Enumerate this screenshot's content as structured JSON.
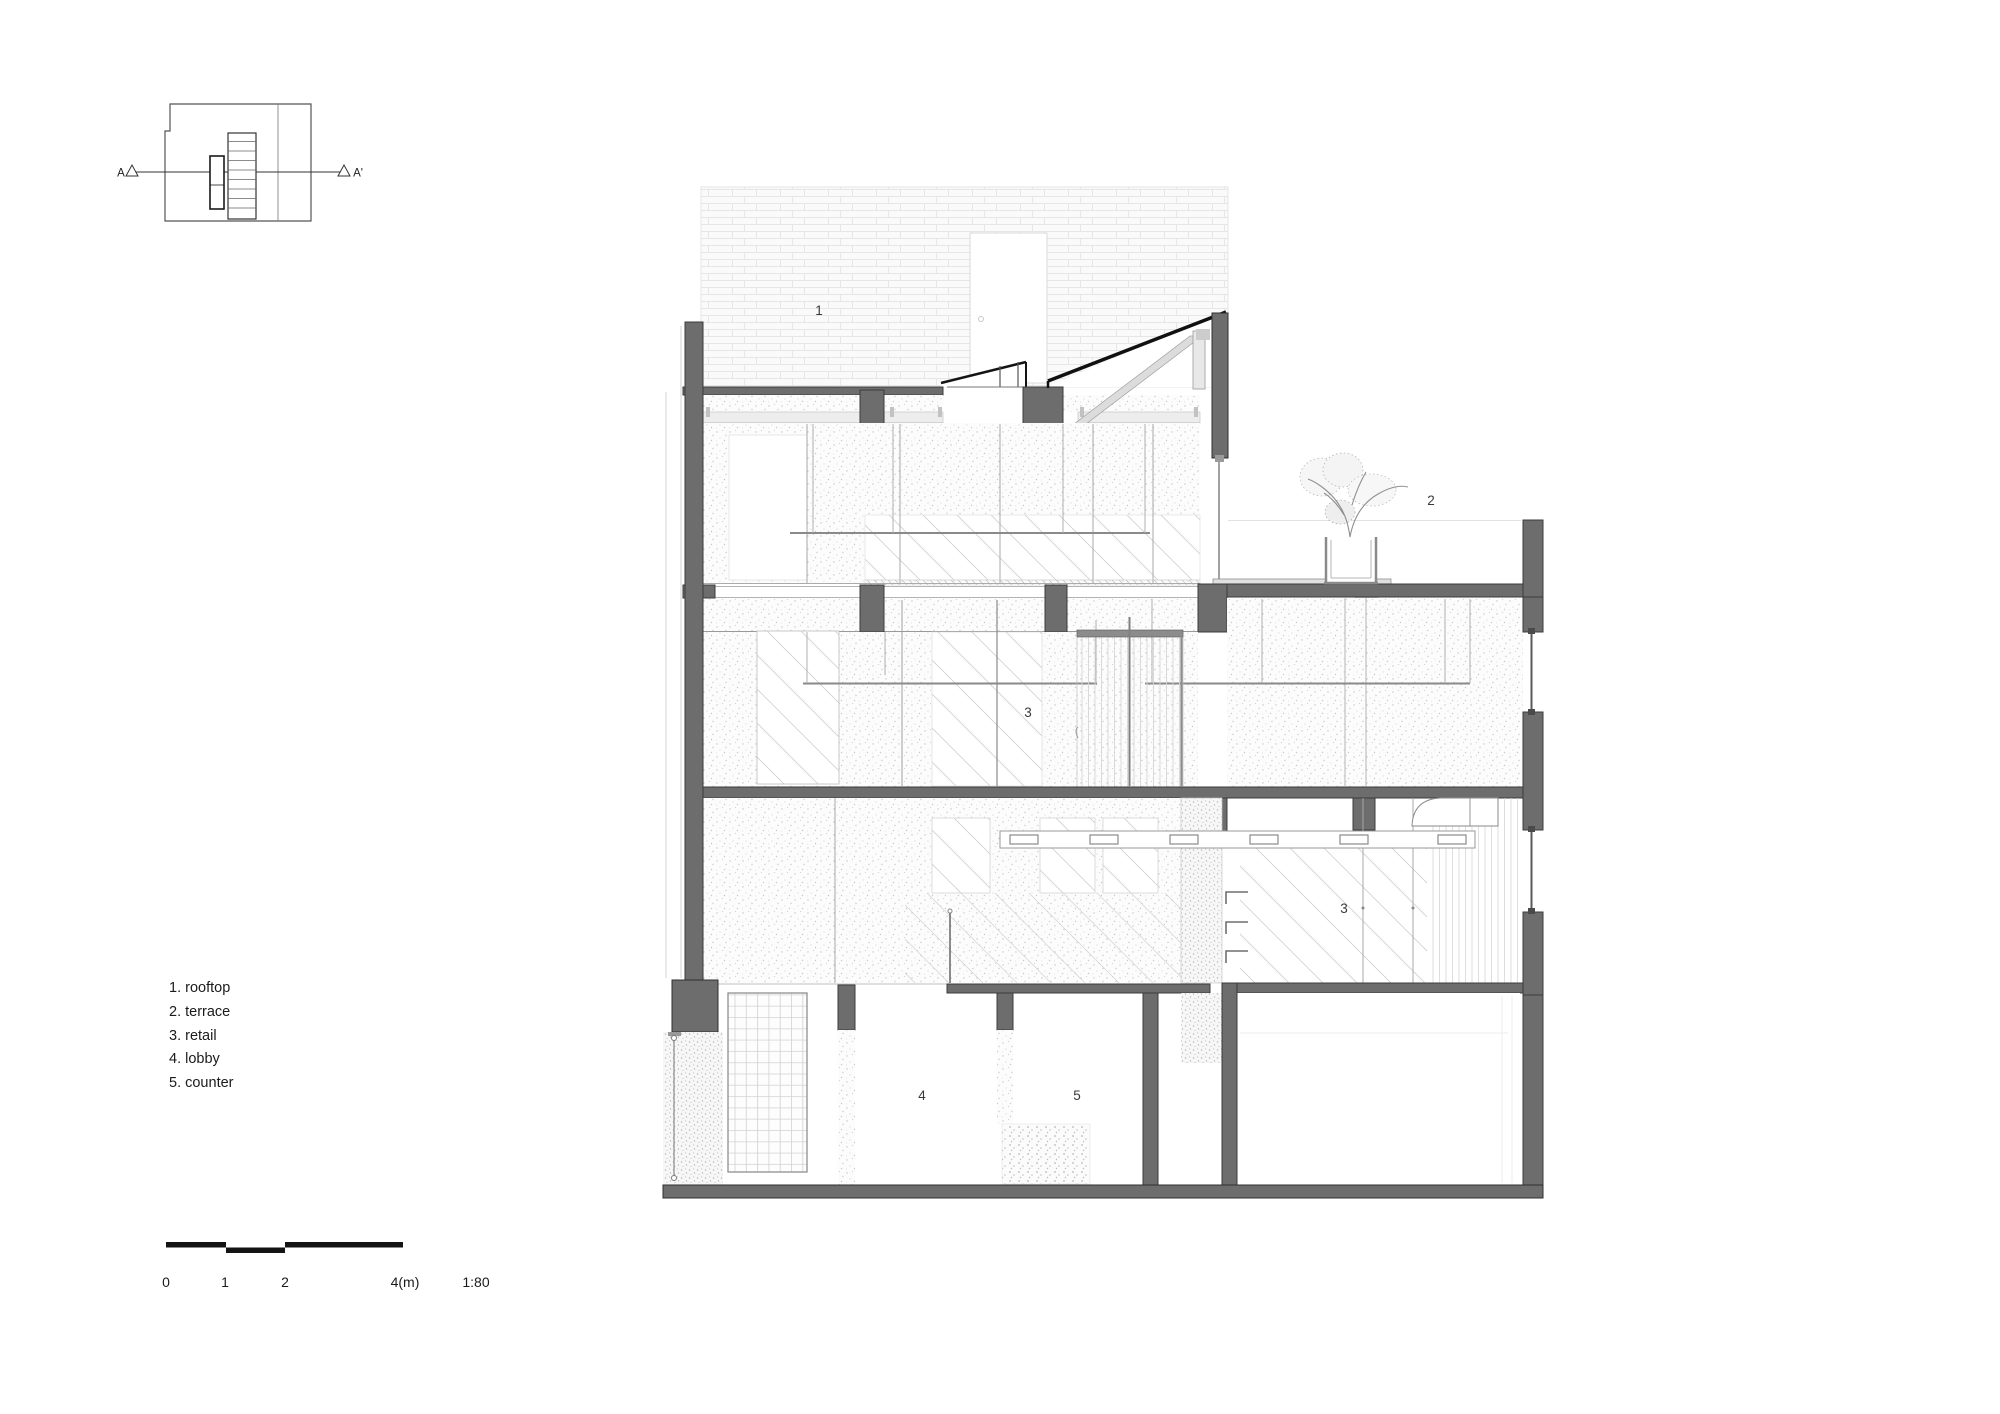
{
  "key_plan": {
    "marker_left": "A",
    "marker_right": "A'"
  },
  "legend": {
    "items": [
      "1. rooftop",
      "2. terrace",
      "3. retail",
      "4. lobby",
      "5. counter"
    ]
  },
  "scale_bar": {
    "ticks": [
      "0",
      "1",
      "2",
      "4(m)"
    ],
    "ratio": "1:80"
  },
  "section": {
    "labels": {
      "rooftop": "1",
      "terrace": "2",
      "retail_upper": "3",
      "retail_lower": "3",
      "lobby": "4",
      "counter": "5"
    },
    "colors": {
      "cut_wall": "#6d6d6d",
      "roof_line": "#141414",
      "light_structure": "#d9d9d9"
    }
  }
}
